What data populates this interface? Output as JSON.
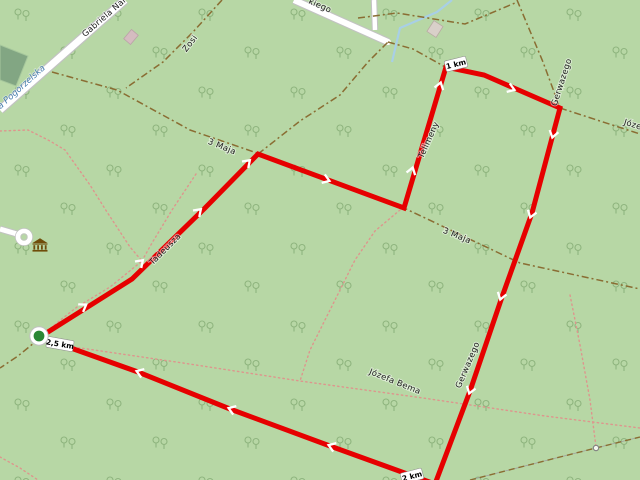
{
  "app": {
    "type": "map-route-planner",
    "view": "openstreetmap-forest-park"
  },
  "map": {
    "colors": {
      "background": "#b7d7a5",
      "tree_symbol": "#87ae77",
      "route": "#e60000",
      "route_arrow": "#ffffff",
      "road_fill": "#ffffff",
      "road_casing": "#c2c2c2",
      "track_dash": "#8a6d33",
      "footpath_dot": "#de958d",
      "stream": "#a8cfe6",
      "pitch": "#82a683",
      "start_marker": "#2a8735",
      "poi_brown": "#6f4d0a"
    },
    "labels": {
      "gabriela": "Gabriela Nar",
      "pogorzelska": "a Pogorzelska",
      "kiego": "kiego",
      "zosi": "Zosi",
      "maja": "3 Maja",
      "telimeny": "Telimeny",
      "tadeusza": "Tadeusza",
      "gerwazego": "Gerwazego",
      "joze": "Józe",
      "bema": "Józefa Bema"
    },
    "distance_markers": {
      "km1": "1 km",
      "km2": "2 km",
      "km25": "2,5 km"
    },
    "route": {
      "waypoints_px": [
        [
          40,
          337
        ],
        [
          132,
          279
        ],
        [
          205,
          208
        ],
        [
          258,
          154
        ],
        [
          404,
          208
        ],
        [
          446,
          67
        ],
        [
          484,
          75
        ],
        [
          560,
          108
        ],
        [
          532,
          213
        ],
        [
          502,
          297
        ],
        [
          470,
          391
        ],
        [
          435,
          484
        ],
        [
          330,
          446
        ],
        [
          230,
          409
        ],
        [
          138,
          372
        ]
      ],
      "closed_loop": true,
      "total_distance_label": "2,5 km"
    },
    "icons": [
      {
        "name": "museum-icon"
      },
      {
        "name": "gate-icon"
      },
      {
        "name": "route-start-marker"
      }
    ]
  }
}
